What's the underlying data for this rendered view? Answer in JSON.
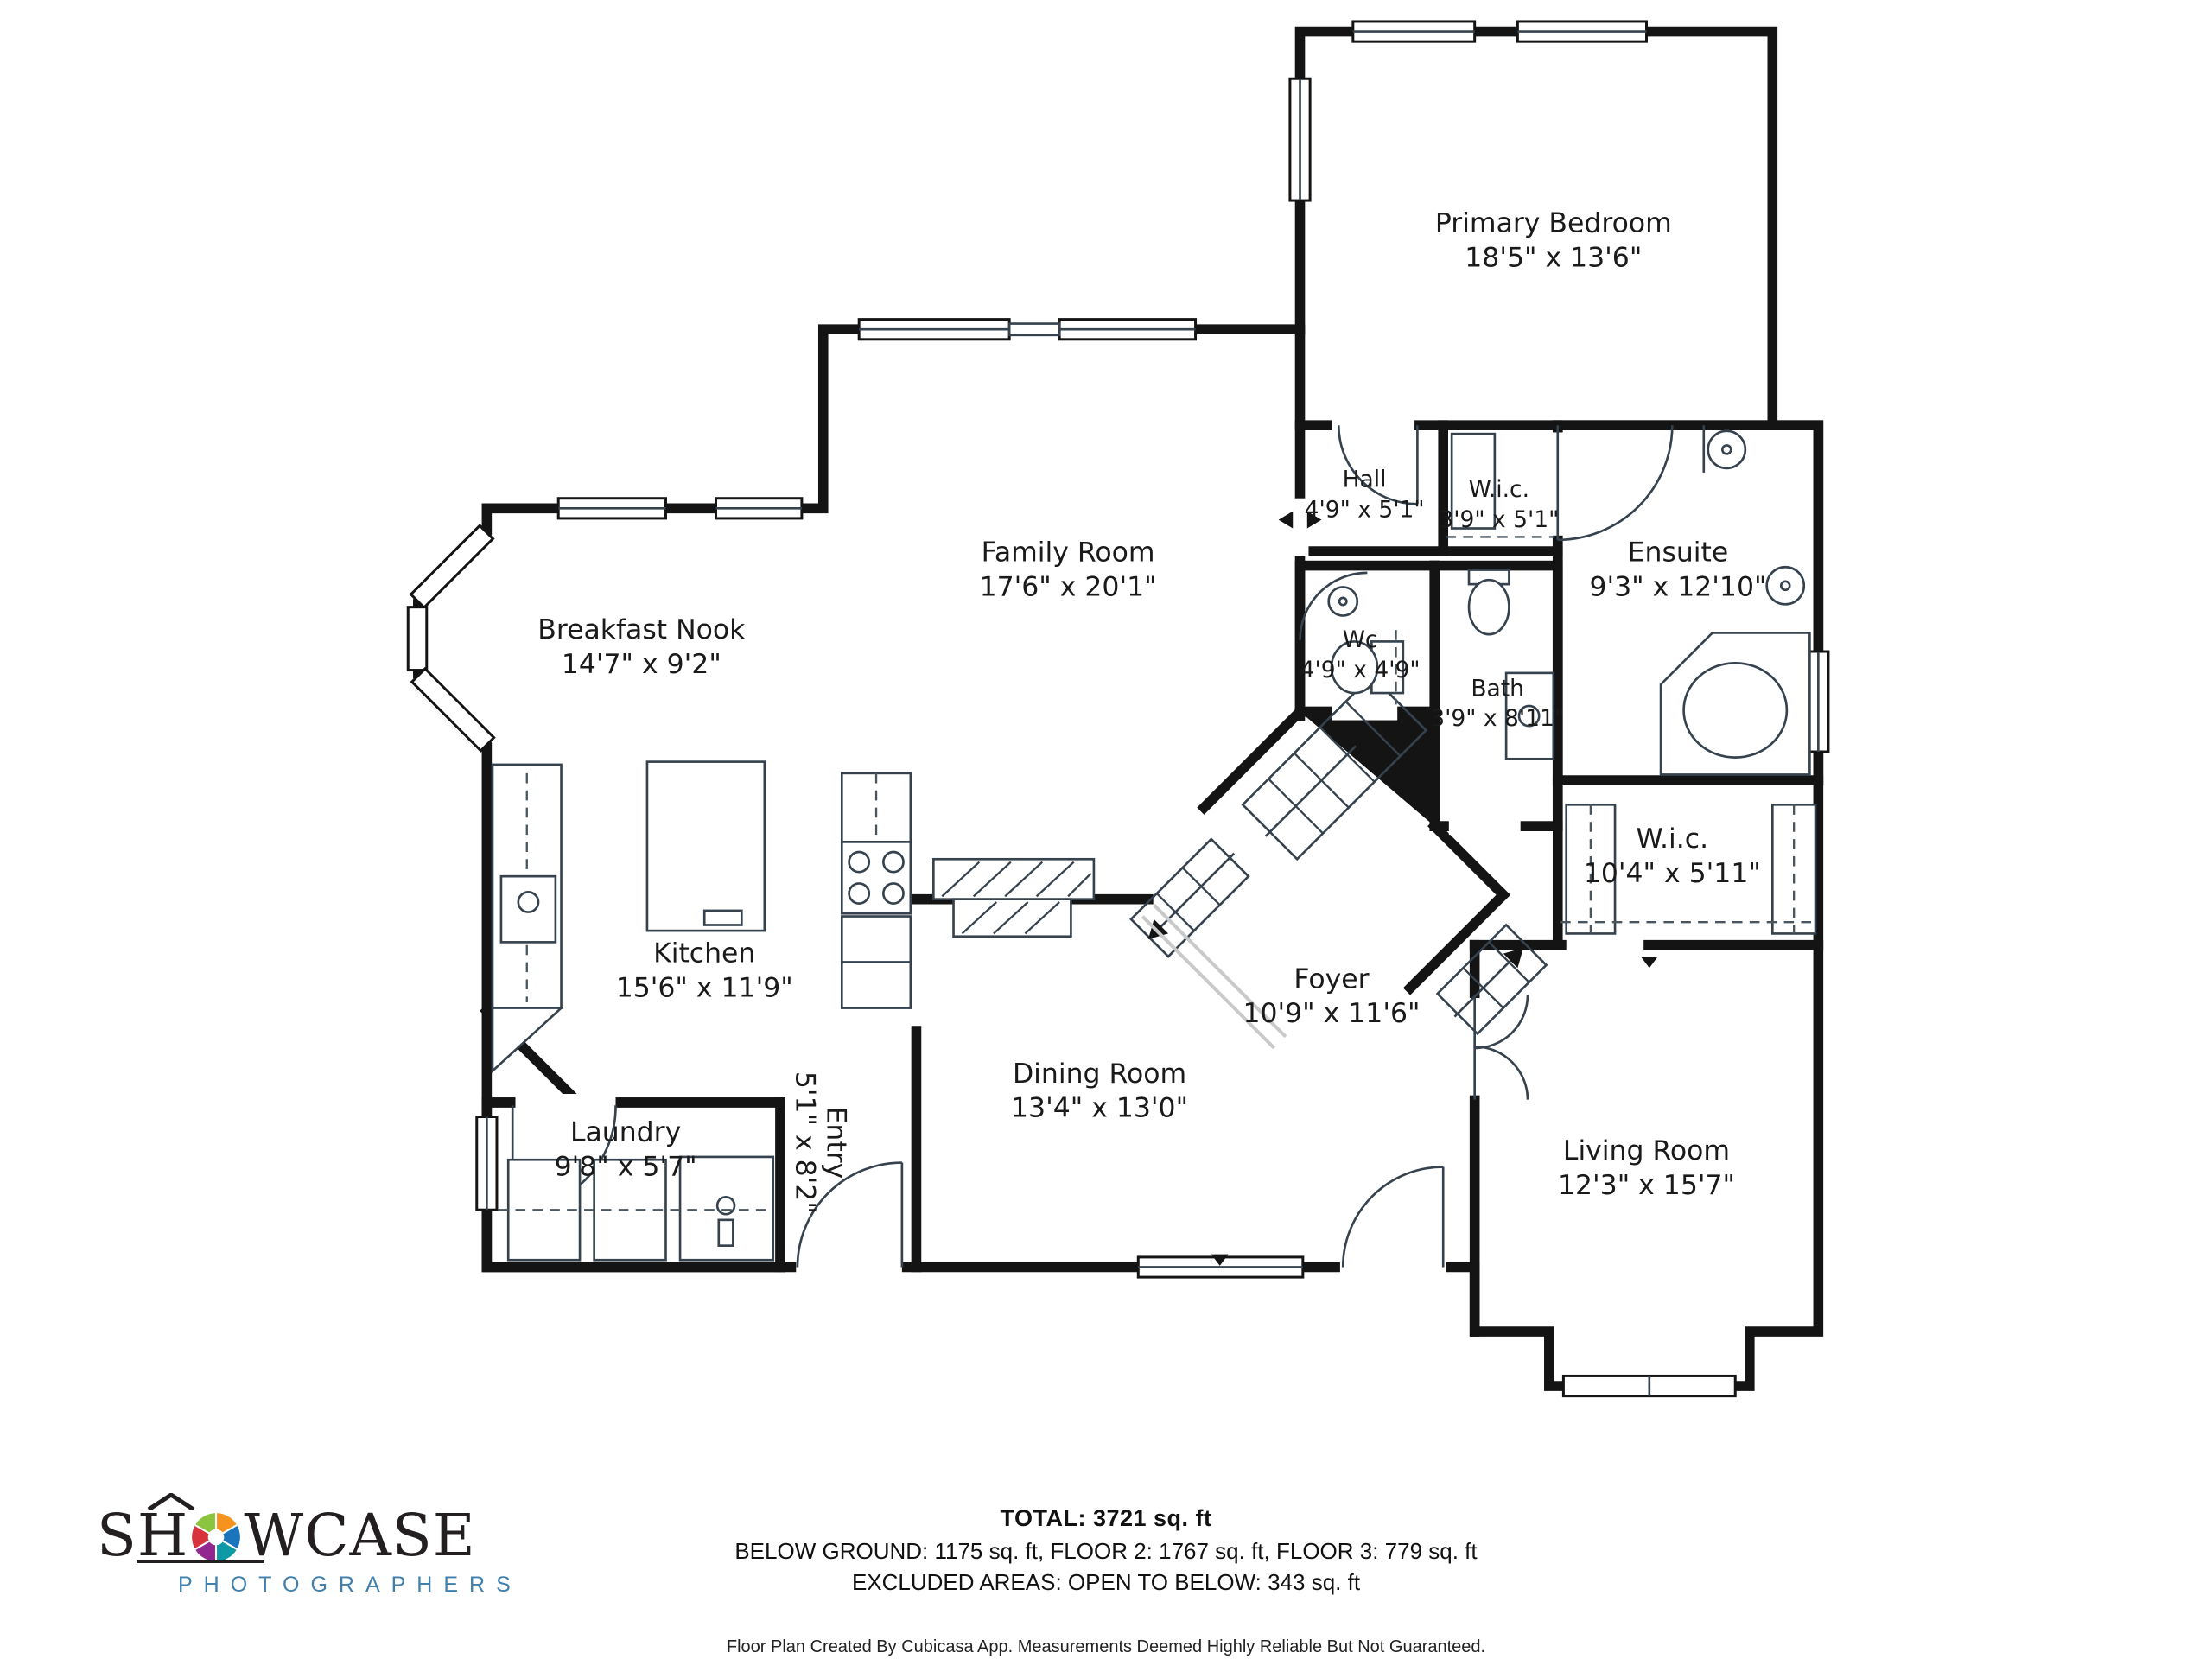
{
  "rooms": {
    "primary_bedroom": {
      "name": "Primary Bedroom",
      "dims": "18'5\" x 13'6\""
    },
    "hall": {
      "name": "Hall",
      "dims": "4'9\" x 5'1\""
    },
    "wic_small": {
      "name": "W.i.c.",
      "dims": "3'9\" x 5'1\""
    },
    "ensuite": {
      "name": "Ensuite",
      "dims": "9'3\" x 12'10\""
    },
    "family_room": {
      "name": "Family Room",
      "dims": "17'6\" x 20'1\""
    },
    "breakfast_nook": {
      "name": "Breakfast Nook",
      "dims": "14'7\" x 9'2\""
    },
    "wc": {
      "name": "Wc",
      "dims": "4'9\" x 4'9\""
    },
    "bath": {
      "name": "Bath",
      "dims": "3'9\" x 8'11\""
    },
    "wic_large": {
      "name": "W.i.c.",
      "dims": "10'4\" x 5'11\""
    },
    "kitchen": {
      "name": "Kitchen",
      "dims": "15'6\" x 11'9\""
    },
    "foyer": {
      "name": "Foyer",
      "dims": "10'9\" x 11'6\""
    },
    "dining_room": {
      "name": "Dining Room",
      "dims": "13'4\" x 13'0\""
    },
    "entry": {
      "name": "Entry",
      "dims": "5'1\" x 8'2\""
    },
    "laundry": {
      "name": "Laundry",
      "dims": "9'8\" x 5'7\""
    },
    "living_room": {
      "name": "Living Room",
      "dims": "12'3\" x 15'7\""
    }
  },
  "footer": {
    "total": "TOTAL: 3721 sq. ft",
    "floors": "BELOW GROUND: 1175 sq. ft, FLOOR 2: 1767 sq. ft, FLOOR 3: 779 sq. ft",
    "excluded": "EXCLUDED AREAS: OPEN TO BELOW: 343 sq. ft",
    "disclaimer": "Floor Plan Created By Cubicasa App. Measurements Deemed Highly Reliable But Not Guaranteed."
  },
  "logo": {
    "title_start": "SH",
    "title_end": "WCASE",
    "subtitle": "PHOTOGRAPHERS",
    "aperture_colors": [
      "#f6921e",
      "#1b75bc",
      "#0d9aa5",
      "#92278f",
      "#d8323c",
      "#8bc53f"
    ]
  },
  "colors": {
    "wall": "#141414",
    "wet_room": "#dcebf8",
    "label": "#1a1a1a",
    "logo_subtitle": "#4180ad"
  }
}
